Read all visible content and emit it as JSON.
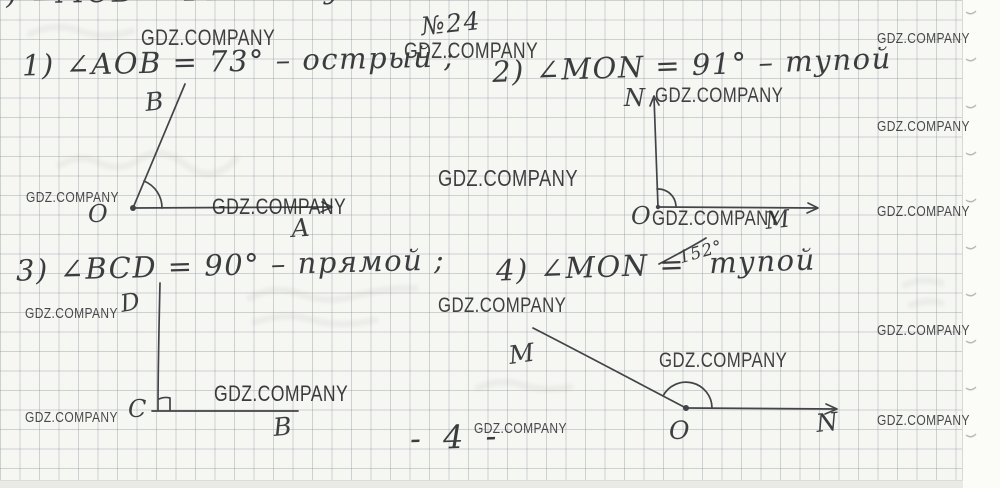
{
  "header": {
    "problem_number": "№24"
  },
  "footer": {
    "page_number": "- 4 -"
  },
  "cropped_top_line": {
    "text": ") ∠MOB = 141° – тупой ."
  },
  "watermark": {
    "text": "GDZ.COMPANY",
    "color": "#2c2c2c"
  },
  "items": [
    {
      "text": "1) ∠AOB = 73° – острый ;"
    },
    {
      "text": "2) ∠MON = 91° – тупой"
    },
    {
      "text": "3) ∠BCD = 90° – прямой ;"
    },
    {
      "pre": "4) ∠MON =",
      "inserted": "152°",
      "post": "тупой"
    }
  ],
  "ink_color": "#434447",
  "watermarks": [
    {
      "x": 141,
      "y": 27,
      "fs": 22,
      "op": 0.9
    },
    {
      "x": 404,
      "y": 40,
      "fs": 22,
      "op": 0.9
    },
    {
      "x": 26,
      "y": 190,
      "fs": 15,
      "op": 0.85
    },
    {
      "x": 212,
      "y": 196,
      "fs": 22,
      "op": 0.92
    },
    {
      "x": 438,
      "y": 167,
      "fs": 23,
      "op": 0.9
    },
    {
      "x": 655,
      "y": 85,
      "fs": 21,
      "op": 0.9
    },
    {
      "x": 652,
      "y": 208,
      "fs": 21,
      "op": 0.9
    },
    {
      "x": 877,
      "y": 31,
      "fs": 15,
      "op": 0.85
    },
    {
      "x": 877,
      "y": 119,
      "fs": 15,
      "op": 0.85
    },
    {
      "x": 877,
      "y": 204,
      "fs": 15,
      "op": 0.85
    },
    {
      "x": 877,
      "y": 323,
      "fs": 15,
      "op": 0.85
    },
    {
      "x": 877,
      "y": 413,
      "fs": 15,
      "op": 0.85
    },
    {
      "x": 25,
      "y": 306,
      "fs": 15,
      "op": 0.85
    },
    {
      "x": 214,
      "y": 383,
      "fs": 22,
      "op": 0.92
    },
    {
      "x": 25,
      "y": 410,
      "fs": 15,
      "op": 0.85
    },
    {
      "x": 438,
      "y": 295,
      "fs": 21,
      "op": 0.9
    },
    {
      "x": 659,
      "y": 350,
      "fs": 21,
      "op": 0.9
    },
    {
      "x": 474,
      "y": 421,
      "fs": 15,
      "op": 0.85
    }
  ],
  "diagrams": [
    {
      "name": "angle-aob-diagram",
      "strokes": [
        "M133 208 L331 207",
        "M322 202 L332 207 L321 212",
        "M133 208 C152 162 172 116 185 84",
        "M162 208 A29 29 0 0 0 144 181"
      ],
      "dots": [
        [
          133,
          208,
          3
        ]
      ],
      "labels": [
        {
          "text": "B",
          "x": 146,
          "y": 111,
          "fs": 25,
          "rot": -6
        },
        {
          "text": "O",
          "x": 88,
          "y": 222,
          "fs": 24,
          "rot": 0
        },
        {
          "text": "A",
          "x": 292,
          "y": 237,
          "fs": 25,
          "rot": -4
        }
      ]
    },
    {
      "name": "angle-nom-diagram",
      "strokes": [
        "M658 207 C657 172 655 132 654 97",
        "M650 106 L654 96 L659 105",
        "M658 207 L817 208",
        "M808 203 L818 208 L807 213",
        "M657 189 A18 18 0 0 1 676 206"
      ],
      "dots": [
        [
          658,
          207,
          2.2
        ]
      ],
      "labels": [
        {
          "text": "N",
          "x": 624,
          "y": 106,
          "fs": 24,
          "rot": 0
        },
        {
          "text": "O",
          "x": 631,
          "y": 224,
          "fs": 24,
          "rot": 0
        },
        {
          "text": "M",
          "x": 766,
          "y": 229,
          "fs": 24,
          "rot": -6
        }
      ]
    },
    {
      "name": "angle-bcd-diagram",
      "strokes": [
        "M160 283 C159 325 158 370 158 410",
        "M152 411 L298 411",
        "M159 399 C163 397 166 397 170 398 L170 410"
      ],
      "dots": [],
      "labels": [
        {
          "text": "D",
          "x": 122,
          "y": 312,
          "fs": 24,
          "rot": -10
        },
        {
          "text": "C",
          "x": 128,
          "y": 417,
          "fs": 24,
          "rot": 0
        },
        {
          "text": "B",
          "x": 274,
          "y": 436,
          "fs": 25,
          "rot": -5
        }
      ]
    },
    {
      "name": "angle-mon-diagram",
      "strokes": [
        "M533 328 C580 352 642 385 686 408",
        "M686 408 L836 409",
        "M826 404 L837 409 L825 414",
        "M663 396 A26 26 0 0 1 712 408"
      ],
      "dots": [
        [
          686,
          408,
          3
        ]
      ],
      "labels": [
        {
          "text": "M",
          "x": 510,
          "y": 364,
          "fs": 25,
          "rot": -8
        },
        {
          "text": "O",
          "x": 669,
          "y": 439,
          "fs": 25,
          "rot": 0
        },
        {
          "text": "N",
          "x": 817,
          "y": 432,
          "fs": 25,
          "rot": -6
        }
      ]
    },
    {
      "name": "insert-caret-mark",
      "strokes": [
        "M659 264 C672 257 690 248 706 238"
      ],
      "dots": [],
      "labels": []
    }
  ],
  "decor": {
    "ghost_paths": [
      "M60 165 q20 -12 40 -2 t40 -4 t46 6 t50 -6",
      "M250 298 q25 -14 50 -4 t55 2 t60 -8",
      "M255 322 q30 -10 58 -2 t62 0",
      "M478 388 q22 -10 44 -3 t48 2",
      "M30 34 q25 -12 50 -3 t52 0",
      "M905 285 q18 -8 36 -2 m-30 22 q16 -6 30 -2"
    ],
    "edge_ticks": {
      "x": 966,
      "start_y": 12,
      "step": 47,
      "count": 10
    }
  }
}
